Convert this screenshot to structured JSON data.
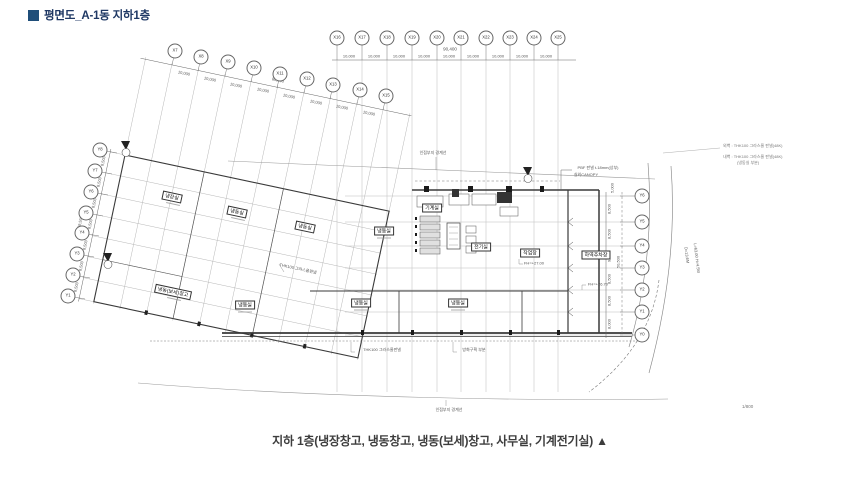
{
  "header": {
    "title": "평면도_A-1동 지하1층"
  },
  "caption": "지하 1층(냉장창고, 냉동창고, 냉동(보세)창고, 사무실, 기계전기실) ▲",
  "scale": "1/800",
  "grid": {
    "top_x": [
      "X16",
      "X17",
      "X18",
      "X19",
      "X20",
      "X21",
      "X22",
      "X23",
      "X24",
      "X25"
    ],
    "diag_x": [
      "X7",
      "X8",
      "X9",
      "X10",
      "X11",
      "X12",
      "X13",
      "X14",
      "X15"
    ],
    "left_y": [
      "Y8",
      "Y7",
      "Y6",
      "Y5",
      "Y4",
      "Y3",
      "Y2",
      "Y1"
    ],
    "right_y": [
      "Y6",
      "Y5",
      "Y4",
      "Y3",
      "Y2",
      "Y1",
      "Y0"
    ]
  },
  "dims": {
    "top_total": "90,400",
    "top_bay": "10,000",
    "diag_total": "80,000",
    "diag_bay": "10,000",
    "left_total": "59,500",
    "left_bay": "8,500",
    "right_total": "50,500",
    "right_bays": [
      "8,500",
      "8,500",
      "9,000",
      "8,500",
      "8,500",
      "8,000"
    ],
    "right_top": "5,000"
  },
  "rooms": {
    "cold_storage": "냉장실",
    "freezer": "냉동실",
    "bonded_freezer": "냉동(보세)창고",
    "workshop": "작업장",
    "loading_dock": "하역주차장",
    "machine_room": "기계실",
    "electric_room": "전기실"
  },
  "levels": {
    "fh_workshop": "FH=+27.00",
    "fh_dock": "FH=+26.70"
  },
  "notes": {
    "boundary": "인접부지 경계선",
    "panel": "THK100 그라스울판넬",
    "fire": "방화구획 부분",
    "canopy1": "PBF 판넬 t-18mm(상부)",
    "canopy2": "실외CANOPY",
    "wall_out": "외벽 : THK100 그라스울 판넬(48K)",
    "wall_in": "내벽 : THK100 그라스울 판넬(48K)",
    "wall_in2": "(냉동실 부분)",
    "road1": "D=13.6M",
    "road2": "L=63.00 H=4.5M"
  }
}
